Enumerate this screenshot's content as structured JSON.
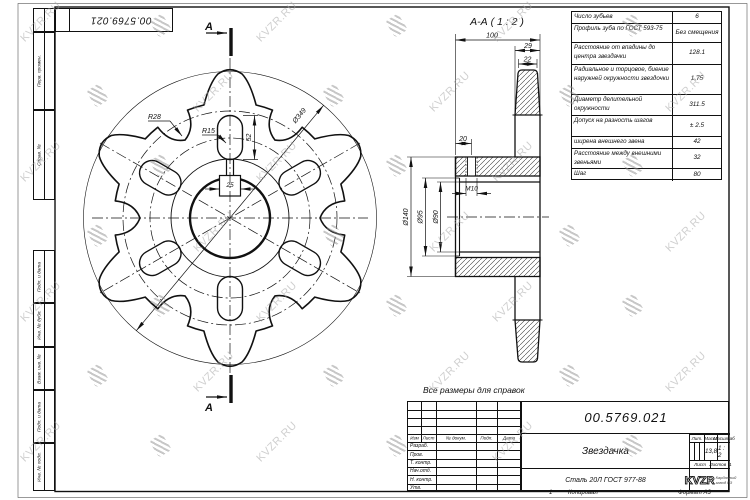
{
  "watermark": {
    "text": "KVZR.RU"
  },
  "frame": {
    "corner_stamp": "00.5769.021"
  },
  "margin_stamps": [
    "Перв. примен.",
    "Справ. №",
    "Подп. и дата",
    "Инв. № дубл.",
    "Взам. инв. №",
    "Подп. и дата",
    "Инв. № подл."
  ],
  "note": "Все размеры для справок",
  "front_view": {
    "section_letter": "A",
    "outer_diameter": "Ø349",
    "scallop_radius": "R28",
    "slot_radius": "R15",
    "slot_length": "52",
    "keyway_width": "25"
  },
  "section_view": {
    "title": "А-А ( 1 : 2 )",
    "width_total": "100",
    "tooth_root_width": "29",
    "tooth_tip_width": "22",
    "hole_offset": "20",
    "thread": "М10",
    "hub_diameter": "Ø140",
    "bore_diameter_outer": "Ø95",
    "bore_diameter_inner": "Ø90"
  },
  "param_table": {
    "rows": [
      {
        "label": "Число зубьев",
        "value": "6"
      },
      {
        "label": "Профиль зуба по ГОСТ 593-75",
        "value": "Без смещения"
      },
      {
        "label": "Расстояние от впадины до центра звездачки",
        "value": "128.1"
      },
      {
        "label": "Радиальное и торцовое, биение наружней окружности звездочки",
        "value": "1,75"
      },
      {
        "label": "Диаметр делительной окружности",
        "value": "311.5"
      },
      {
        "label": "Допуск на разность шагов",
        "value": "± 2.5"
      },
      {
        "label": "ширена внешнего звена",
        "value": "42"
      },
      {
        "label": "Расстояние между внешними звеньями",
        "value": "32"
      },
      {
        "label": "Шаг",
        "value": "80"
      }
    ]
  },
  "title_block": {
    "doc_number": "00.5769.021",
    "part_name": "Звездачка",
    "material": "Сталь 20Л ГОСТ 977-88",
    "rev_headers": [
      "Изм",
      "Лист",
      "№ докум.",
      "Подп.",
      "Дата"
    ],
    "sig_rows": [
      "Разраб.",
      "Пров.",
      "Т. контр.",
      "Нач.отд.",
      "Н. контр.",
      "Утв."
    ],
    "headers": {
      "lit": "Лит.",
      "mass": "Масса",
      "scale": "Масштаб",
      "sheet": "Лист",
      "sheets": "Листов"
    },
    "mass_value": "13,8",
    "scale_value": "1 : 2",
    "sheets_value": "1",
    "company": {
      "logo_text": "KVZR",
      "tagline_line1": "Карданный",
      "tagline_line2": "завод РЗ"
    },
    "copy_col": "1",
    "copy_note": "Копировал",
    "format_note": "Формат А3"
  }
}
